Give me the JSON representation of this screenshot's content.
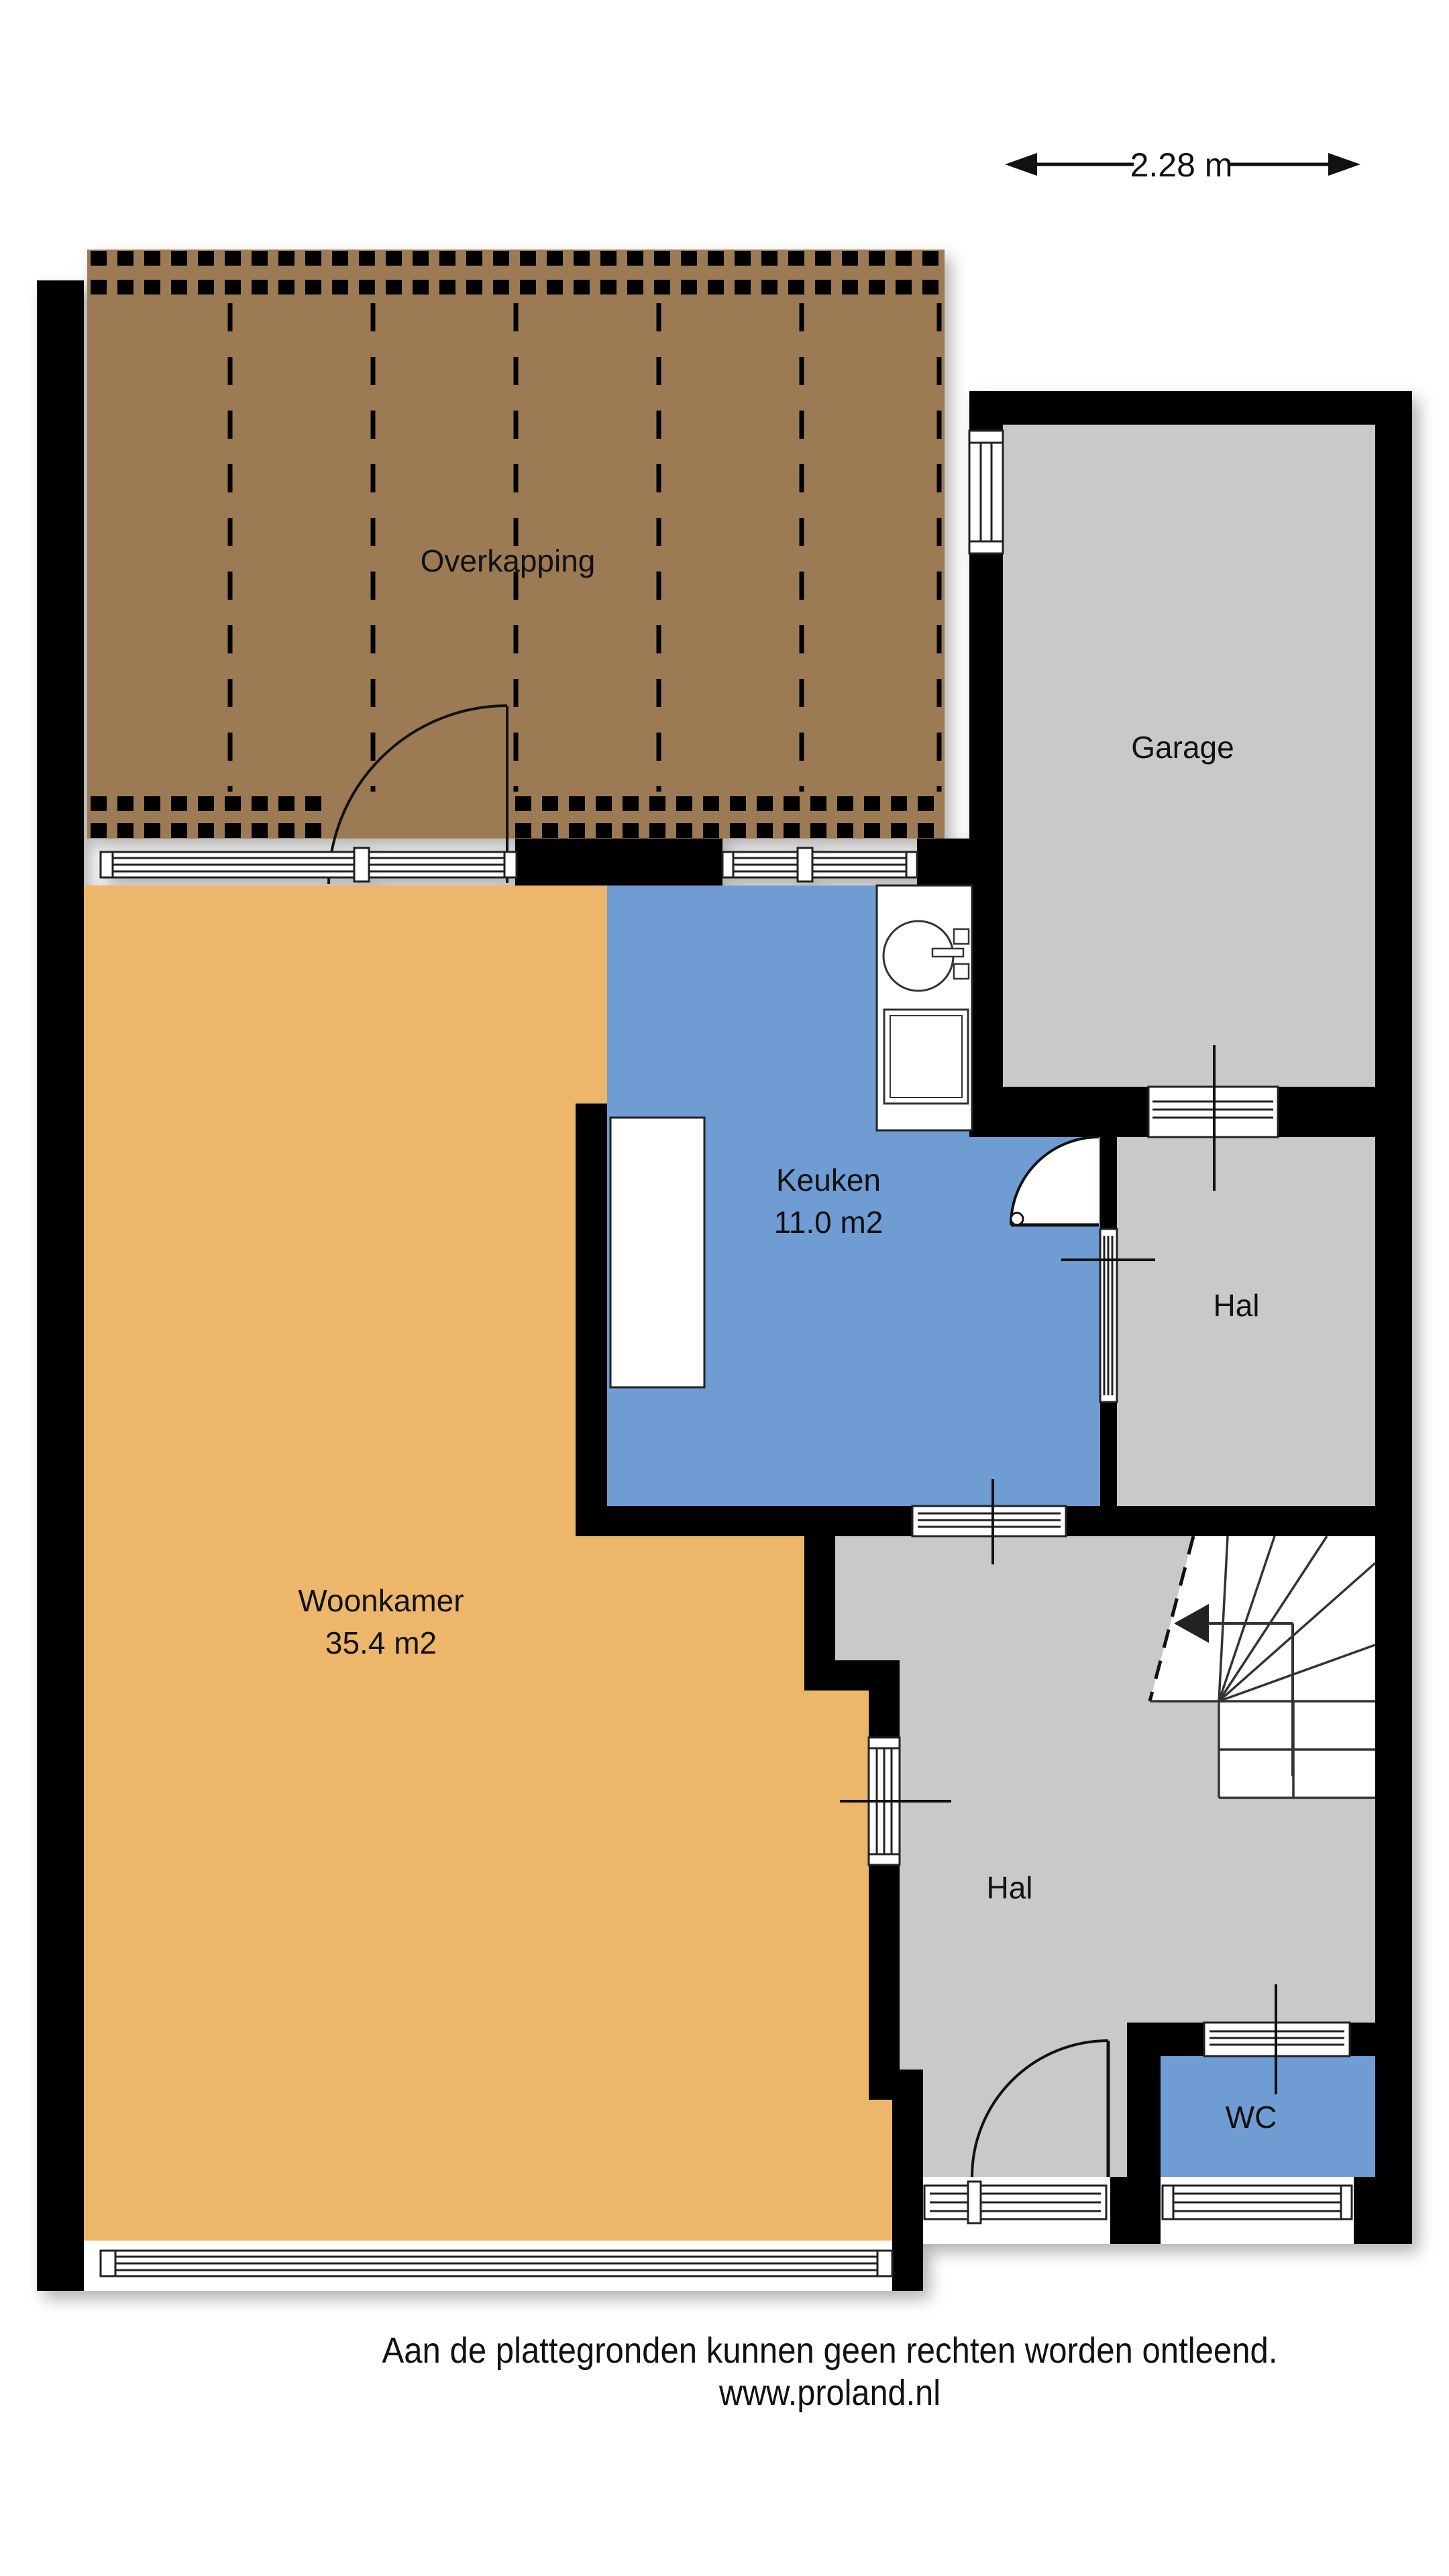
{
  "scale_bar": {
    "label": "2.28 m"
  },
  "rooms": {
    "overkapping": {
      "label": "Overkapping"
    },
    "garage": {
      "label": "Garage"
    },
    "keuken": {
      "label": "Keuken",
      "area": "11.0 m2"
    },
    "hal_boven": {
      "label": "Hal"
    },
    "woonkamer": {
      "label": "Woonkamer",
      "area": "35.4 m2"
    },
    "hal": {
      "label": "Hal"
    },
    "wc": {
      "label": "WC"
    }
  },
  "footer": {
    "line1": "Aan de plattegronden kunnen geen rechten worden ontleend.",
    "line2": "www.proland.nl"
  },
  "colors": {
    "wall": "#000000",
    "room_gray": "#C9C9C9",
    "living_orange": "#ECB76B",
    "kitchen_blue": "#6F9CD3",
    "canopy_brown": "#9C7A53",
    "background": "#FFFFFF"
  }
}
